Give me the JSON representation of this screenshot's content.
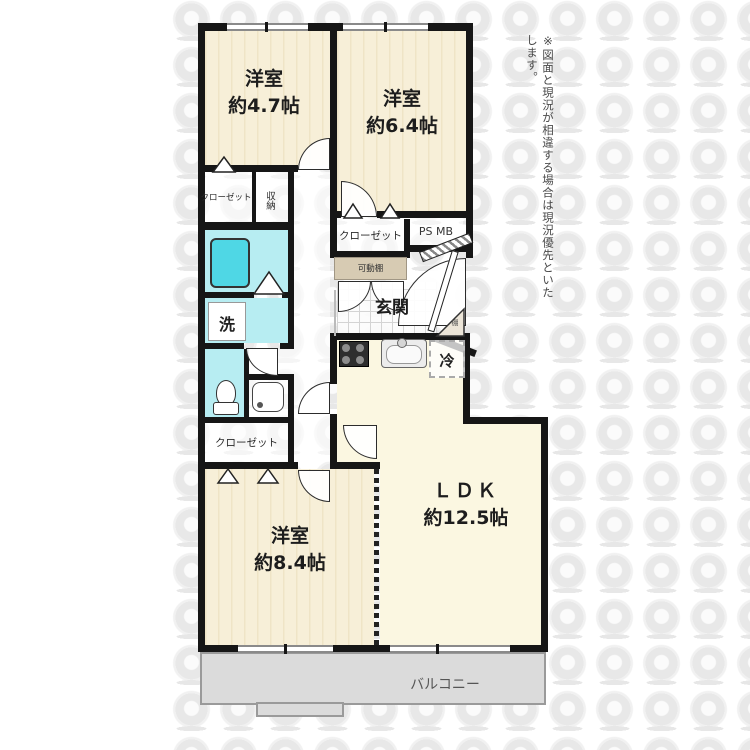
{
  "disclaimer": "※図面と現況が相違する場合は現況優先といたします。",
  "rooms": {
    "bedroom_47": {
      "name": "洋室",
      "size": "約4.7帖"
    },
    "bedroom_64": {
      "name": "洋室",
      "size": "約6.4帖"
    },
    "bedroom_84": {
      "name": "洋室",
      "size": "約8.4帖"
    },
    "ldk": {
      "name": "ＬＤＫ",
      "size": "約12.5帖"
    },
    "entrance": "玄関",
    "balcony": "バルコニー"
  },
  "labels": {
    "closet_upper_left": "クローゼット",
    "closet_center": "クローゼット",
    "closet_lower": "クローゼット",
    "storage": "収納",
    "ps_mb": "PS MB",
    "movable_shelf": "可動棚",
    "laundry": "洗",
    "refrigerator": "冷",
    "shelf": "棚"
  },
  "colors": {
    "wall": "#161616",
    "bedroom_floor": "#f4ead0",
    "ldk_floor": "#fbf7e1",
    "wet_area": "#b7edf2",
    "bathtub": "#4fd7e5",
    "balcony": "#dbdbdb",
    "shelf_tan": "#d7cbb3"
  }
}
